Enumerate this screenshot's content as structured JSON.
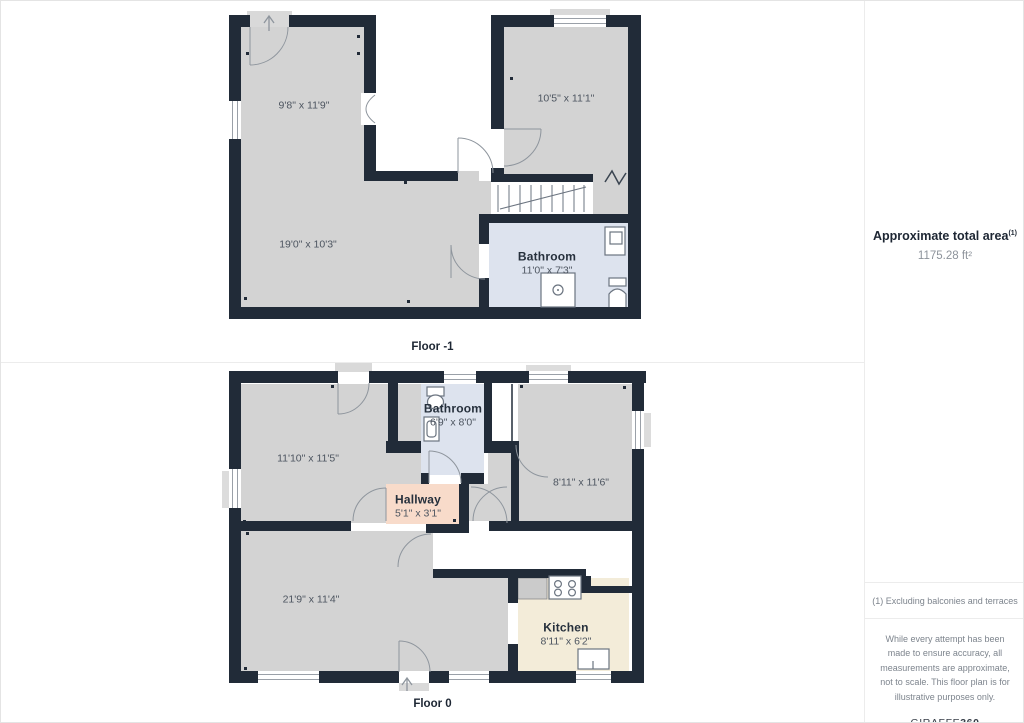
{
  "floors": [
    {
      "caption": "Floor -1",
      "rooms": [
        {
          "dims": "9'8\" x 11'9\"",
          "x": 303,
          "y": 104
        },
        {
          "dims": "10'5\" x 11'1\"",
          "x": 565,
          "y": 97
        },
        {
          "dims": "19'0\" x 10'3\"",
          "x": 307,
          "y": 243
        },
        {
          "name": "Bathroom",
          "dims": "11'0\" x 7'3\"",
          "x": 546,
          "y": 262
        }
      ]
    },
    {
      "caption": "Floor 0",
      "rooms": [
        {
          "dims": "11'10\" x 11'5\"",
          "x": 307,
          "y": 457
        },
        {
          "name": "Bathroom",
          "dims": "6'9\" x 8'0\"",
          "x": 452,
          "y": 414
        },
        {
          "dims": "8'11\" x 11'6\"",
          "x": 580,
          "y": 481
        },
        {
          "name": "Hallway",
          "dims": "5'1\" x 3'1\"",
          "x": 417,
          "y": 505
        },
        {
          "dims": "21'9\" x 11'4\"",
          "x": 310,
          "y": 598
        },
        {
          "name": "Kitchen",
          "dims": "8'11\" x 6'2\"",
          "x": 565,
          "y": 633
        }
      ]
    }
  ],
  "sidebar": {
    "area_title": "Approximate total area",
    "area_sup": "(1)",
    "area_value": "1175.28 ft²",
    "footnote": "(1) Excluding balconies and terraces",
    "disclaimer": "While every attempt has been made to ensure accuracy, all measurements are approximate, not to scale. This floor plan is for illustrative purposes only.",
    "logo_text": "GIRAFFE",
    "logo_bold": "360"
  },
  "colors": {
    "wall": "#212b38",
    "floor": "#d3d3d3",
    "bathroom_floor": "#dde3ee",
    "hallway_floor": "#f8dbca",
    "kitchen_floor": "#f3ecd9"
  }
}
